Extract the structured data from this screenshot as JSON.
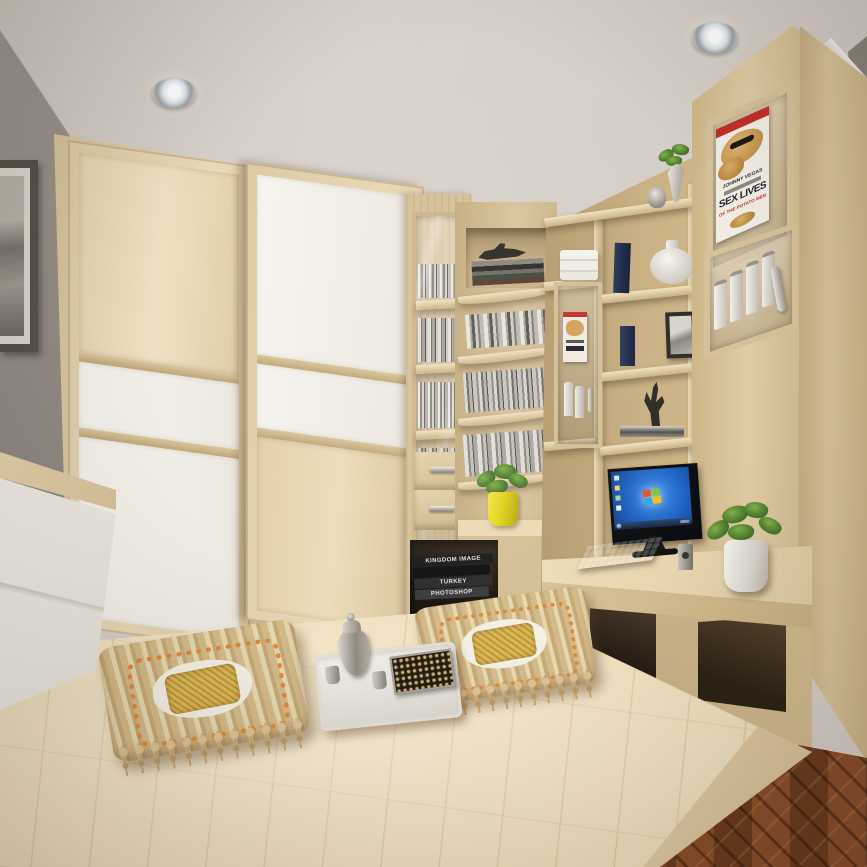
{
  "scene": {
    "description": "Tatami-style bedroom with built-in light-wood wardrobe, corner bookshelves, display cabinets and a study bench with computer",
    "clock_time_shown": "10:08",
    "monitor_wallpaper": "windows-7-logo"
  },
  "palette": {
    "ceiling": "#d6cfc9",
    "wallGray": "#97908a",
    "molding": "#efece7",
    "woodLight": "#e2d1ad",
    "woodMid": "#d2bd94",
    "woodDark": "#b79f74",
    "woodFrame": "#dcc9a4",
    "panelWhite": "#f4f1ec",
    "platformTop": "#f0e0c0",
    "platformFace": "#e3d0ad",
    "parquetBase": "#7c4526",
    "screenBlue": "#2a6fd2",
    "taskbarDark": "#16243c",
    "plantGreen": "#4e7c33",
    "potYellow": "#e3d41e",
    "potWhite": "#efece7",
    "cushionBase": "#d8c18e",
    "cushionOrange": "#e0873a",
    "cushionGold": "#d4b249",
    "trayWhite": "#edeae4",
    "silver": "#b9b3a9",
    "bookNavy": "#1d2b4a",
    "sculptureBlack": "#2e2a26",
    "posterRed": "#c03028",
    "posterTan": "#d2a158"
  },
  "poster": {
    "artist_line": "JOHNNY VEGAS",
    "title": "SEX LIVES",
    "subtitle": "OF THE POTATO MEN"
  },
  "books": {
    "spines": [
      "KINGDOM IMAGE",
      "TURKEY",
      "PHOTOSHOP"
    ]
  }
}
